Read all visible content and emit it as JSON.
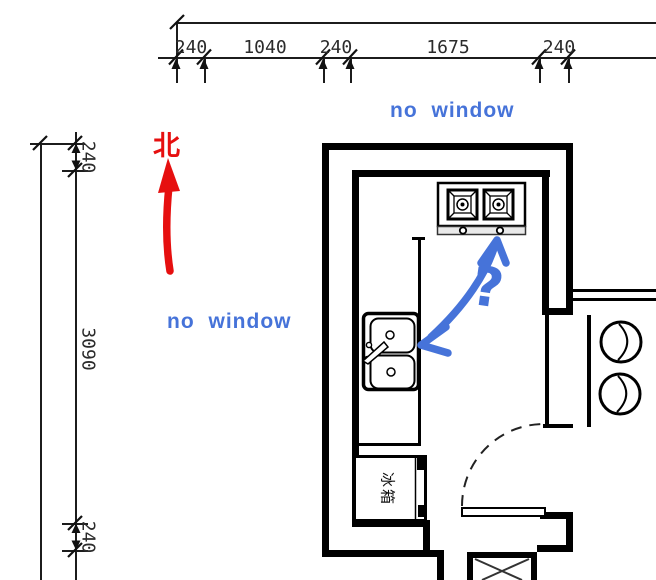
{
  "plan": {
    "title": "kitchen-floor-plan",
    "north_label": "北",
    "fridge_label": "冰箱",
    "question_mark": "?",
    "no_window_top": "no window",
    "no_window_left": "no window"
  },
  "dimensions": {
    "top": [
      "240",
      "1040",
      "240",
      "1675",
      "240"
    ],
    "left": [
      "240",
      "3090",
      "240"
    ]
  },
  "colors": {
    "wall": "#000000",
    "dimension_line": "#1c1c1c",
    "annotation_blue": "#4673d9",
    "north_red": "#e60f0f"
  }
}
